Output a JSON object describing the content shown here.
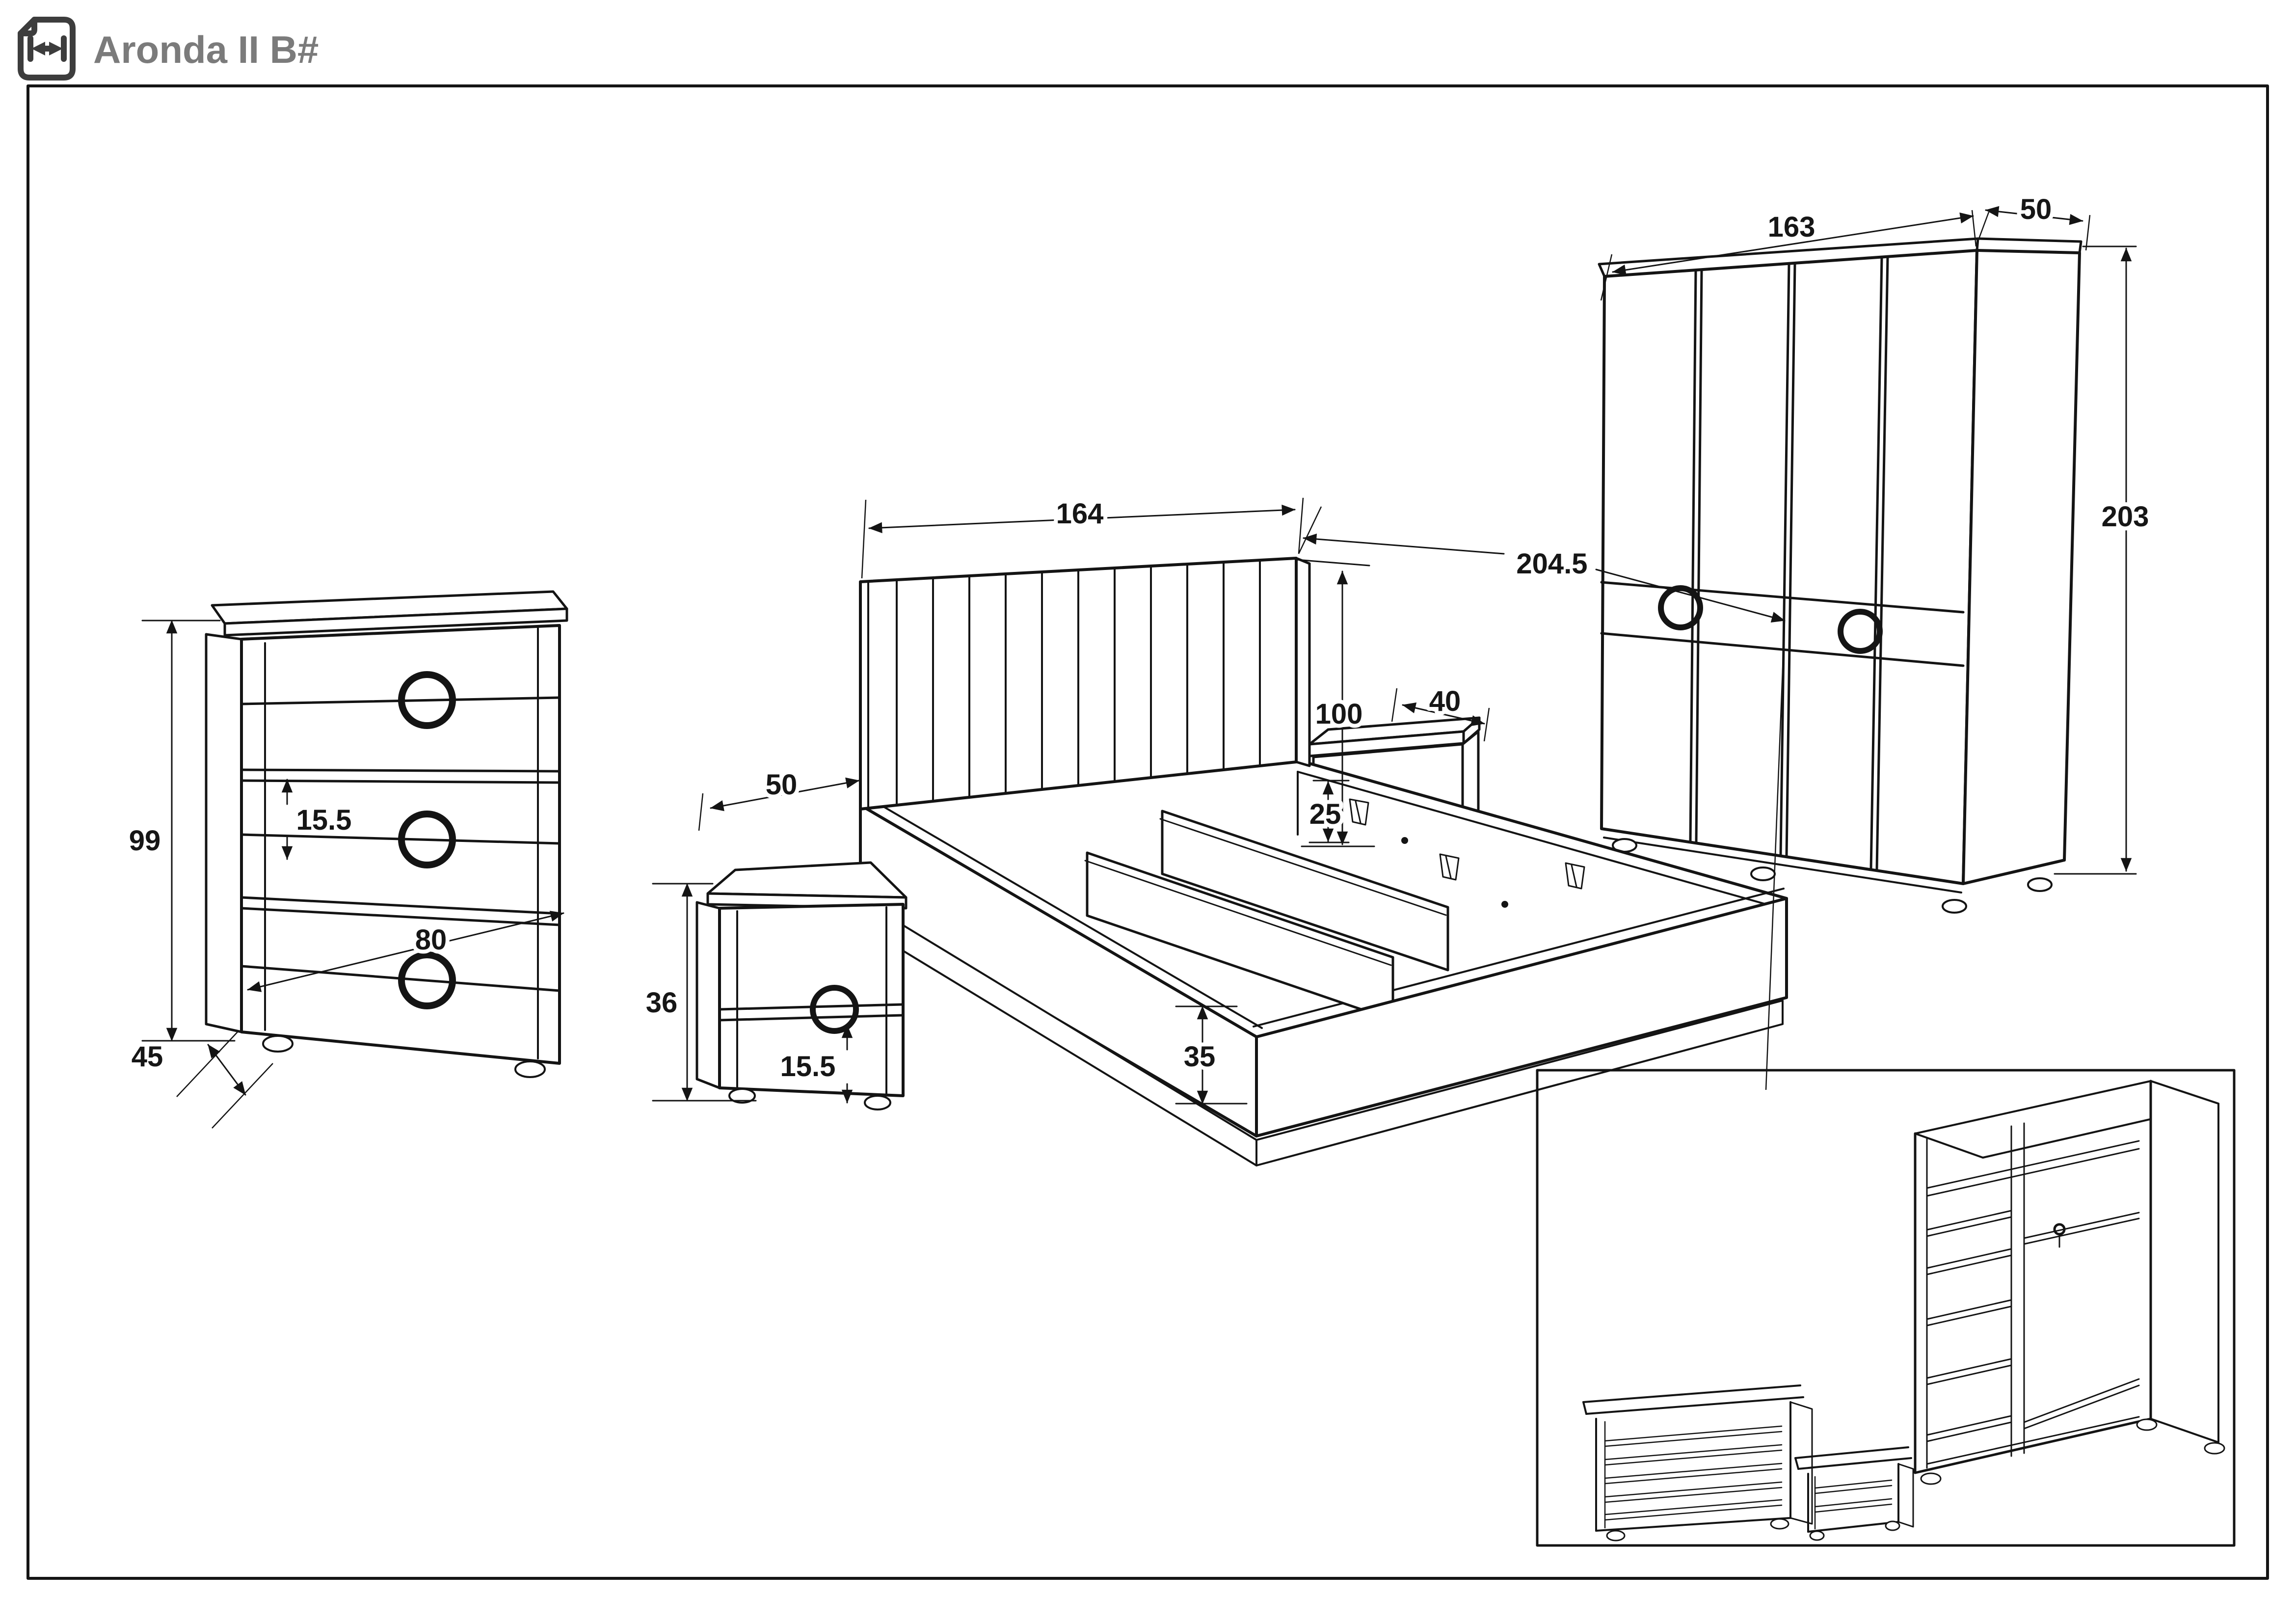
{
  "title": "Aronda II B#",
  "icon": "width-dimension-page-icon",
  "colors": {
    "line": "#141414",
    "title": "#7b7b7b",
    "background": "#ffffff"
  },
  "pieces": {
    "dresser": {
      "label": "chest-of-drawers",
      "height": "99",
      "drawer_height": "15.5",
      "width": "80",
      "depth": "45"
    },
    "nightstand": {
      "label": "nightstand",
      "width": "50",
      "height": "36",
      "drawer_height": "15.5",
      "depth": "40"
    },
    "bed": {
      "label": "storage-bed",
      "headboard_width": "164",
      "headboard_height": "100",
      "frame_inner_height": "25",
      "base_height": "35",
      "length": "204.5"
    },
    "wardrobe": {
      "label": "wardrobe",
      "width": "163",
      "depth": "50",
      "height": "203"
    }
  }
}
